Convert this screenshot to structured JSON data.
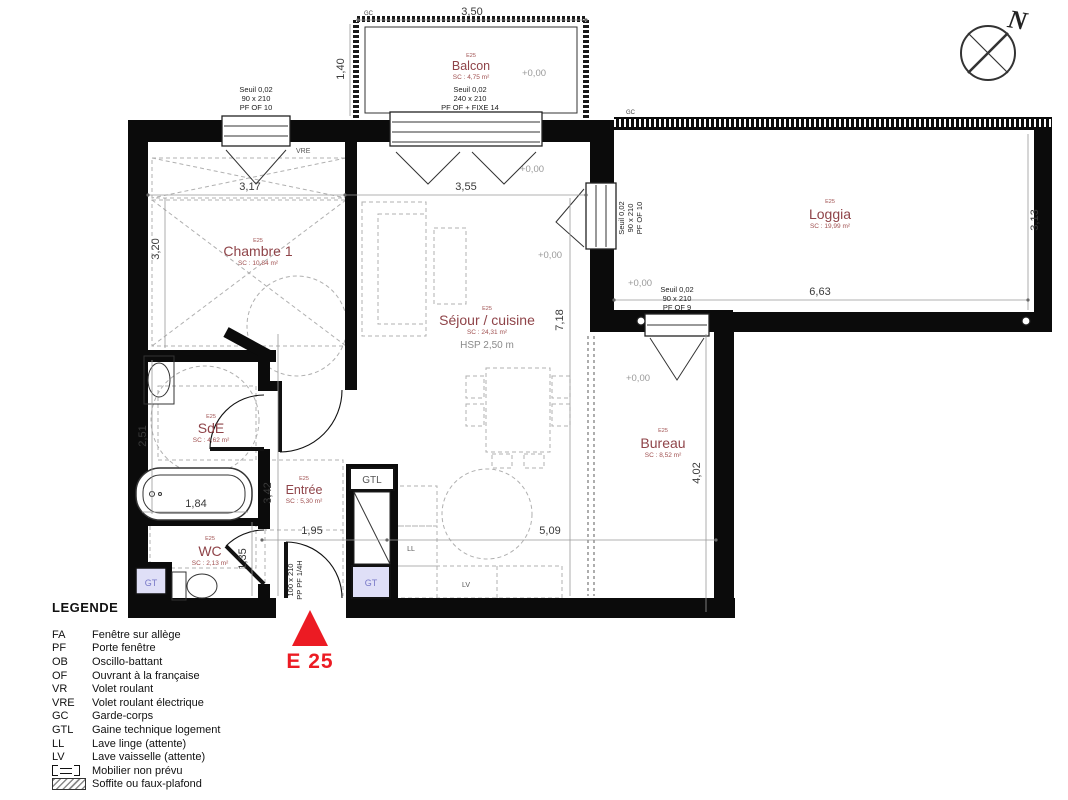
{
  "plan": {
    "rooms": [
      {
        "code": "E25",
        "name": "Balcon",
        "area": "SC : 4,75 m²"
      },
      {
        "code": "E25",
        "name": "Chambre 1",
        "area": "SC : 10,84 m²"
      },
      {
        "code": "E25",
        "name": "Séjour / cuisine",
        "area": "SC : 24,31 m²"
      },
      {
        "code": "E25",
        "name": "Loggia",
        "area": "SC : 19,99 m²"
      },
      {
        "code": "E25",
        "name": "SdE",
        "area": "SC : 4,62 m²"
      },
      {
        "code": "E25",
        "name": "WC",
        "area": "SC : 2,13 m²"
      },
      {
        "code": "E25",
        "name": "Entrée",
        "area": "SC : 5,30 m²"
      },
      {
        "code": "E25",
        "name": "Bureau",
        "area": "SC : 8,52 m²"
      }
    ],
    "dimensions": [
      "3,50",
      "1,40",
      "3,17",
      "3,55",
      "3,20",
      "7,18",
      "3,13",
      "6,63",
      "2,51",
      "1,84",
      "3,42",
      "1,95",
      "5,09",
      "1,35",
      "4,02"
    ],
    "level_label": "+0,00",
    "openings": {
      "window_chambre": [
        "Seuil 0,02",
        "90 x 210",
        "PF OF 10"
      ],
      "window_balcon": [
        "Seuil 0,02",
        "240 x 210",
        "PF OF + FIXE 14"
      ],
      "window_loggia_side": [
        "Seuil 0,02",
        "90 x 210",
        "PF OF 10"
      ],
      "window_loggia_bureau": [
        "Seuil 0,02",
        "90 x 210",
        "PF OF 9"
      ],
      "entry_door": [
        "100 x 210",
        "PP PF 1/4H"
      ]
    },
    "tags": {
      "vre": "VRE",
      "gc": "GC",
      "gtl": "GTL",
      "gt": "GT",
      "ll": "LL",
      "lv": "LV",
      "hsp": "HSP 2,50 m"
    },
    "marker": "E 25",
    "compass_north": "N"
  },
  "legend": {
    "title": "LEGENDE",
    "entries": [
      {
        "abbr": "FA",
        "label": "Fenêtre sur allège"
      },
      {
        "abbr": "PF",
        "label": "Porte fenêtre"
      },
      {
        "abbr": "OB",
        "label": "Oscillo-battant"
      },
      {
        "abbr": "OF",
        "label": "Ouvrant à la française"
      },
      {
        "abbr": "VR",
        "label": "Volet roulant"
      },
      {
        "abbr": "VRE",
        "label": "Volet roulant électrique"
      },
      {
        "abbr": "GC",
        "label": "Garde-corps"
      },
      {
        "abbr": "GTL",
        "label": "Gaine technique logement"
      },
      {
        "abbr": "LL",
        "label": "Lave linge (attente)"
      },
      {
        "abbr": "LV",
        "label": "Lave vaisselle (attente)"
      },
      {
        "abbr": "",
        "label": "Mobilier non prévu"
      },
      {
        "abbr": "",
        "label": "Soffite ou faux-plafond"
      }
    ]
  },
  "colors": {
    "wall": "#0b0b0b",
    "room_label": "#8f4449",
    "marker_red": "#ec1b23",
    "gt_fill": "#dfdff7",
    "gt_text": "#7878c8"
  }
}
